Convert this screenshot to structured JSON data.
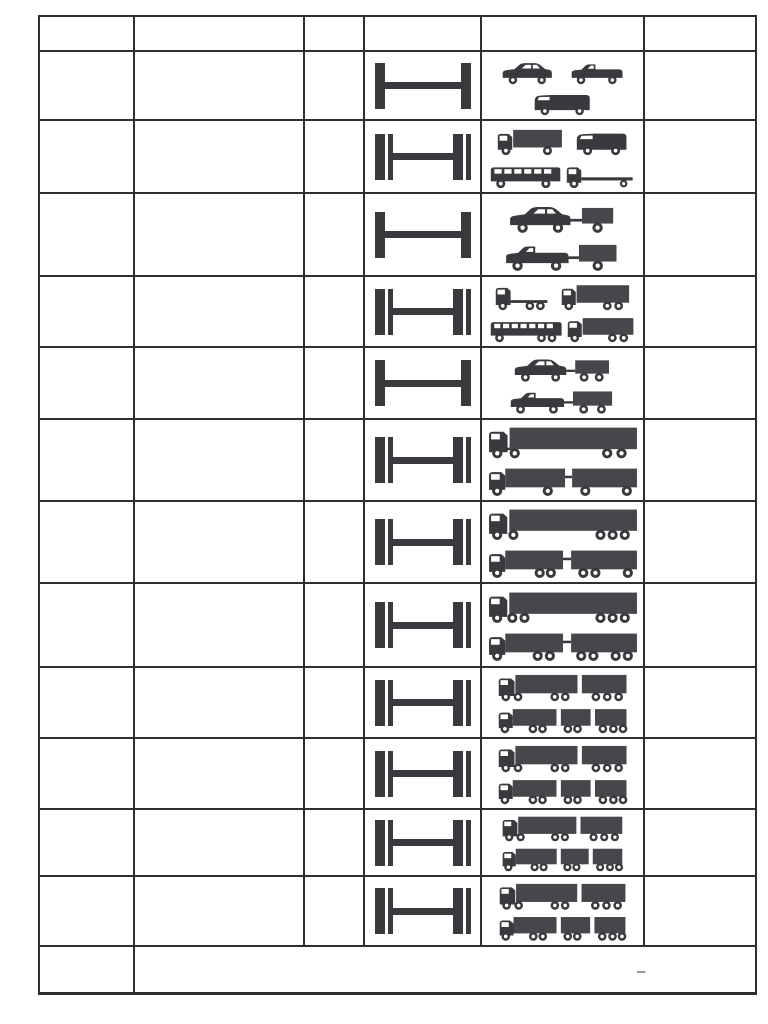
{
  "page": {
    "background": "#ffffff"
  },
  "colors": {
    "ink": "#3a3a3e",
    "ink_light": "#46464b",
    "border": "#2f2f2f"
  },
  "table": {
    "header": {
      "cells": [
        "",
        "",
        "",
        "",
        "",
        ""
      ]
    },
    "rows": [
      {
        "axle_diagram": "single-axle-pair",
        "vehicle_lines": [
          [
            "passenger-car",
            "convertible-car"
          ],
          [
            "van"
          ]
        ]
      },
      {
        "axle_diagram": "double-axle-pair",
        "vehicle_lines": [
          [
            "light-box-truck",
            "delivery-van"
          ],
          [
            "minibus",
            "flatbed-truck"
          ]
        ]
      },
      {
        "axle_diagram": "single-axle-pair",
        "vehicle_lines": [
          [
            "car-with-trailer"
          ],
          [
            "pickup-with-trailer"
          ]
        ]
      },
      {
        "axle_diagram": "double-axle-pair",
        "vehicle_lines": [
          [
            "tractor-unit-3axle",
            "box-truck-3axle"
          ],
          [
            "bus-3axle",
            "truck-3axle"
          ]
        ]
      },
      {
        "axle_diagram": "single-axle-pair",
        "vehicle_lines": [
          [
            "car-with-tandem-trailer"
          ],
          [
            "pickup-with-tandem-trailer"
          ]
        ]
      },
      {
        "axle_diagram": "double-axle-pair",
        "vehicle_lines": [
          [
            "semitrailer-truck-4axle"
          ],
          [
            "truck-with-trailer-4axle"
          ]
        ]
      },
      {
        "axle_diagram": "double-axle-pair",
        "vehicle_lines": [
          [
            "semitrailer-truck-5axle"
          ],
          [
            "truck-with-trailer-5axle"
          ]
        ]
      },
      {
        "axle_diagram": "double-axle-pair",
        "vehicle_lines": [
          [
            "semitrailer-truck-6axle"
          ],
          [
            "truck-with-trailer-6axle"
          ]
        ]
      },
      {
        "axle_diagram": "double-axle-pair",
        "vehicle_lines": [
          [
            "road-train-semitrailer"
          ],
          [
            "road-train-truck"
          ]
        ]
      },
      {
        "axle_diagram": "double-axle-pair",
        "vehicle_lines": [
          [
            "road-train-semitrailer"
          ],
          [
            "road-train-truck"
          ]
        ]
      },
      {
        "axle_diagram": "double-axle-pair",
        "vehicle_lines": [
          [
            "road-train-semitrailer"
          ],
          [
            "road-train-truck"
          ]
        ]
      },
      {
        "axle_diagram": "double-axle-pair",
        "vehicle_lines": [
          [
            "road-train-semitrailer"
          ],
          [
            "road-train-truck"
          ]
        ]
      }
    ],
    "footer": {
      "dash": "–"
    }
  }
}
